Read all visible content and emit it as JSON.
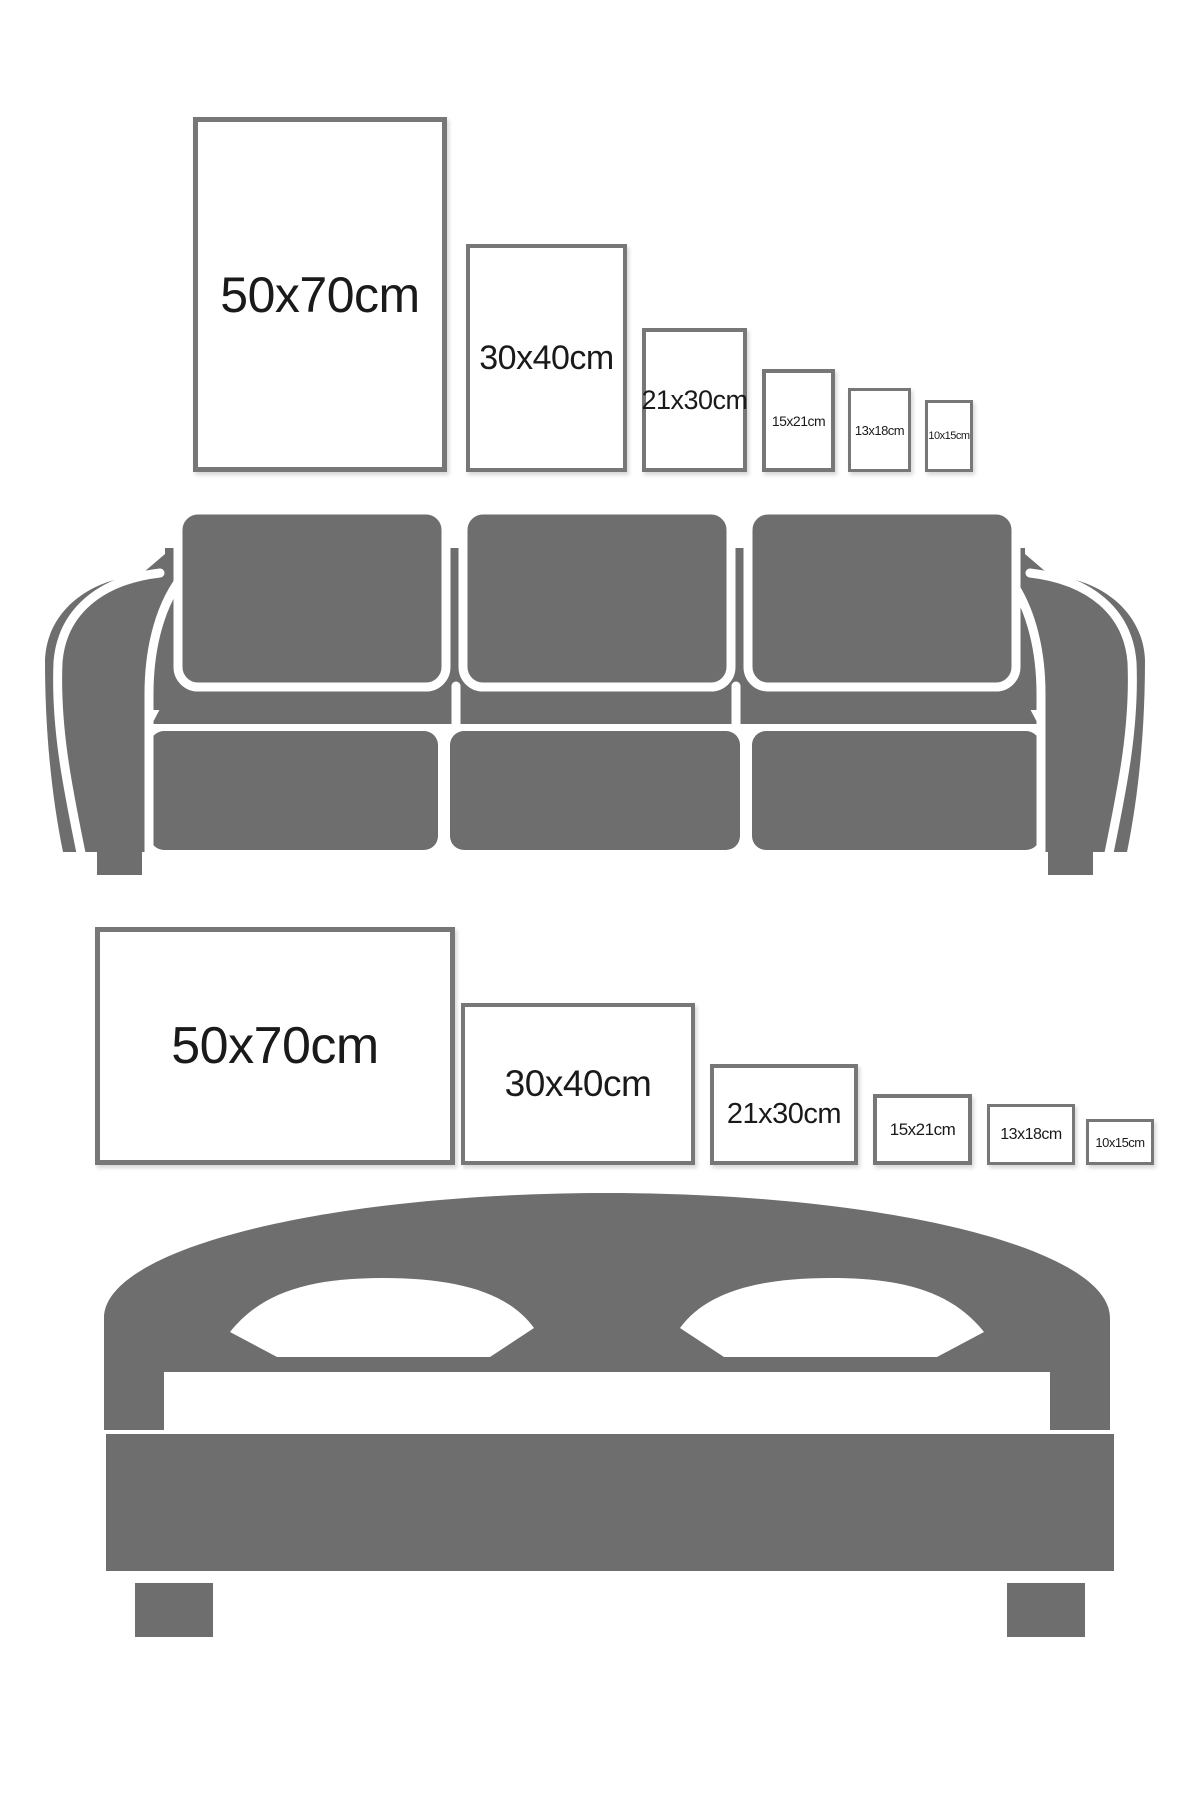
{
  "colors": {
    "furniture_gray": "#6e6e6e",
    "frame_border": "#777777",
    "label_text": "#1a1a1a",
    "background": "#ffffff"
  },
  "sofa_section": {
    "furniture": "sofa-icon",
    "orientation": "portrait",
    "frames": [
      {
        "label": "50x70cm"
      },
      {
        "label": "30x40cm"
      },
      {
        "label": "21x30cm"
      },
      {
        "label": "15x21cm"
      },
      {
        "label": "13x18cm"
      },
      {
        "label": "10x15cm"
      }
    ]
  },
  "bed_section": {
    "furniture": "bed-icon",
    "orientation": "landscape",
    "frames": [
      {
        "label": "50x70cm"
      },
      {
        "label": "30x40cm"
      },
      {
        "label": "21x30cm"
      },
      {
        "label": "15x21cm"
      },
      {
        "label": "13x18cm"
      },
      {
        "label": "10x15cm"
      }
    ]
  }
}
